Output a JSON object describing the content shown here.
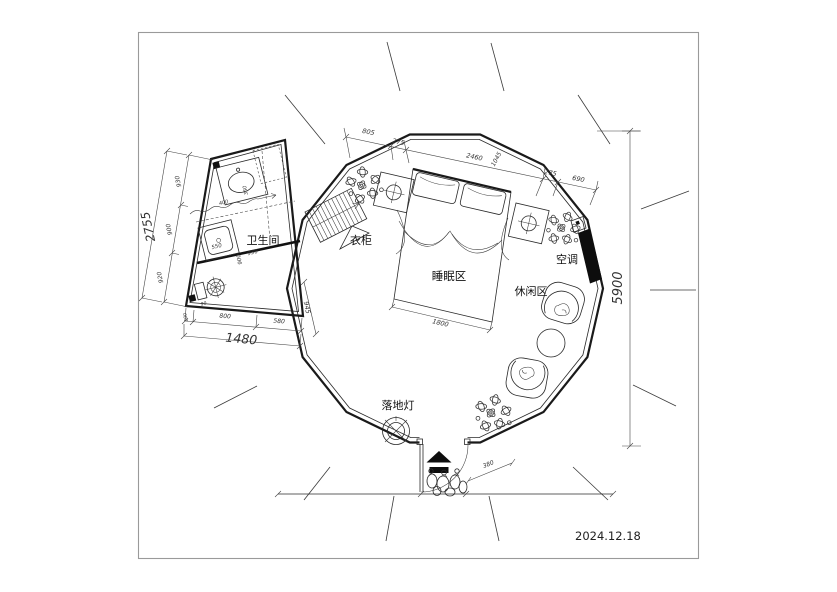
{
  "date": "2024.12.18",
  "labels": {
    "bathroom": "卫生间",
    "wardrobe": "衣柜",
    "sleeping_area": "睡眠区",
    "leisure_area": "休闲区",
    "air_conditioner": "空调",
    "floor_lamp": "落地灯"
  },
  "dimensions": {
    "top_chain": [
      "805",
      "275",
      "2460",
      "1045",
      "275",
      "690"
    ],
    "tent_height": "5900",
    "bed_width": "1800",
    "door_offset": "380",
    "bathroom": {
      "left_chain": [
        "930",
        "900",
        "920"
      ],
      "left_total": "2755",
      "bottom_chain": [
        "100",
        "800",
        "580"
      ],
      "bottom_total": "1480",
      "right_side": "945",
      "inner_basin_w": "400",
      "inner_basin_d": "350",
      "inner_shower": "550",
      "inner_mid_w": "900",
      "inner_mid_d": "930",
      "inner_corner": "90"
    }
  }
}
